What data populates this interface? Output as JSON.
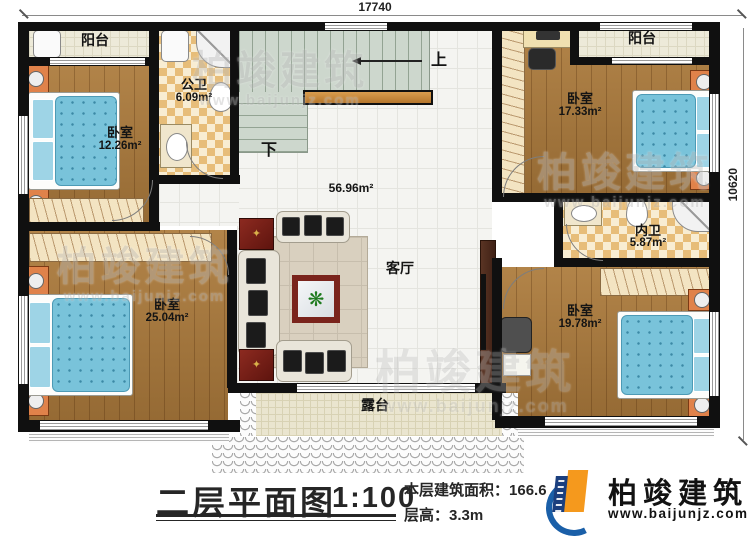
{
  "dimensions": {
    "width_mm": "17740",
    "height_mm": "10620"
  },
  "rooms": {
    "balcony_tl": {
      "label": "阳台"
    },
    "bath_public": {
      "label": "公卫",
      "area": "6.09m²"
    },
    "bedroom_tl": {
      "label": "卧室",
      "area": "12.26m²"
    },
    "bedroom_bl": {
      "label": "卧室",
      "area": "25.04m²"
    },
    "living": {
      "label": "客厅",
      "area": "56.96m²"
    },
    "balcony_tr": {
      "label": "阳台"
    },
    "bedroom_tr": {
      "label": "卧室",
      "area": "17.33m²"
    },
    "bath_private": {
      "label": "内卫",
      "area": "5.87m²"
    },
    "bedroom_br": {
      "label": "卧室",
      "area": "19.78m²"
    },
    "terrace": {
      "label": "露台"
    }
  },
  "stairs": {
    "up_label": "上",
    "down_label": "下"
  },
  "title_block": {
    "title": "二层平面图",
    "scale": "1:100",
    "area_label": "本层建筑面积：",
    "area_value": "166.6",
    "height_label": "层高：",
    "height_value": "3.3m"
  },
  "brand": {
    "name": "柏竣建筑",
    "website": "www.baijunjz.com"
  },
  "watermark": {
    "name": "柏竣建筑",
    "website": "www.baijunjz.com"
  },
  "colors": {
    "wall": "#101010",
    "wood_floor": "#a57a42",
    "bed_blue": "#79c3da",
    "bath_tile": "#e7bd79",
    "stairs": "#cdd7cd",
    "accent_table": "#7a241c",
    "brand_blue": "#1a5fa8",
    "brand_orange": "#f5991d"
  }
}
